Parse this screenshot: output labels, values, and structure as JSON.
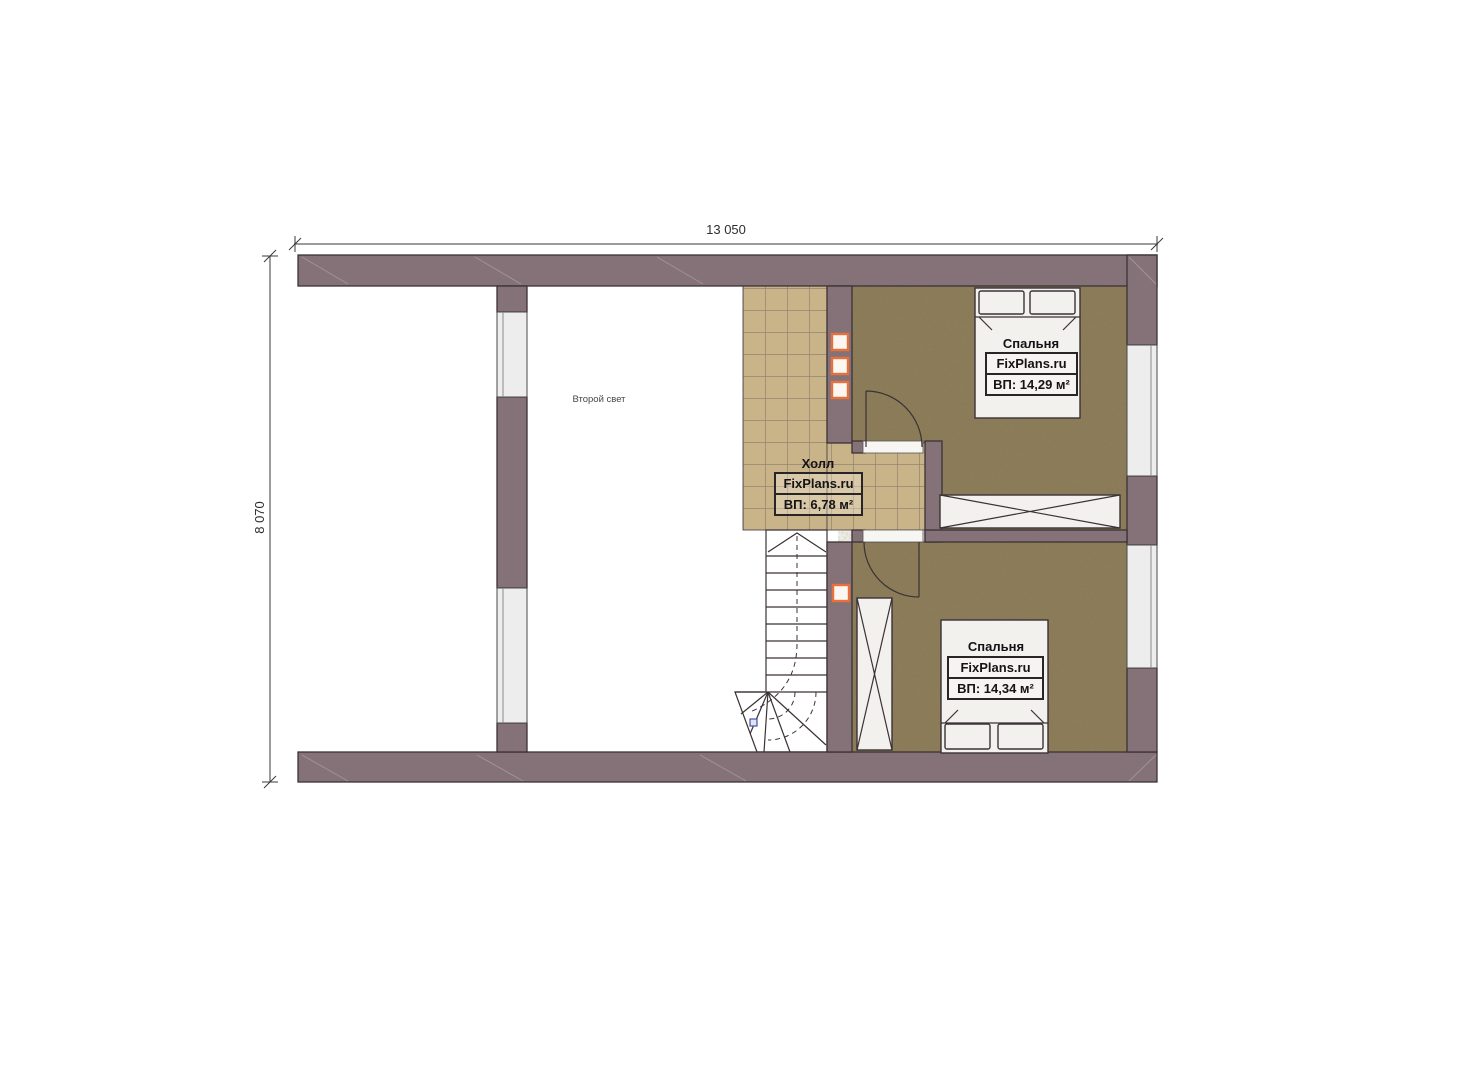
{
  "dimensions": {
    "top": "13 050",
    "left": "8 070"
  },
  "rooms": {
    "second_light": {
      "name": "Второй свет"
    },
    "hall": {
      "name": "Холл",
      "brand": "FixPlans.ru",
      "area": "ВП: 6,78 м²"
    },
    "bedroom_top": {
      "name": "Спальня",
      "brand": "FixPlans.ru",
      "area": "ВП: 14,29 м²"
    },
    "bedroom_bottom": {
      "name": "Спальня",
      "brand": "FixPlans.ru",
      "area": "ВП: 14,34 м²"
    }
  },
  "colors": {
    "wall": "#857278",
    "outline": "#3b3236",
    "tile": "#c9b489",
    "tile_grout": "#8a7a6a",
    "bedroom_floor": "#8a7a57",
    "window": "#ecedec",
    "accent_orange": "#e8703a",
    "furniture": "#f2f1ee",
    "marker_blue": "#4553a0"
  }
}
